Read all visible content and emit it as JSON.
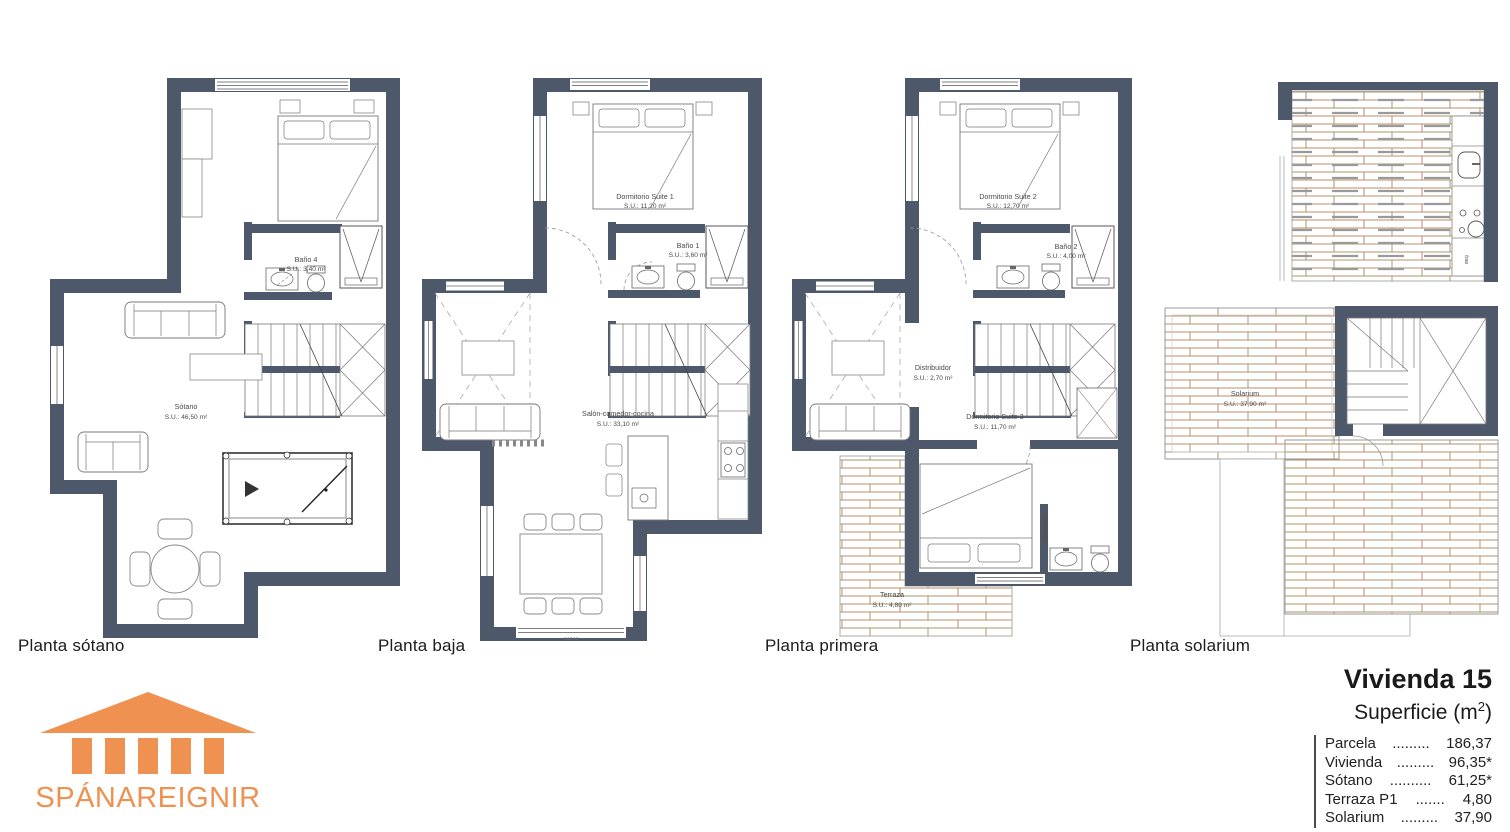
{
  "colors": {
    "wall": "#4e586b",
    "wood": "#b5916e",
    "accent": "#ef9150"
  },
  "plans": [
    {
      "caption": "Planta sótano",
      "rooms": {
        "bano4": {
          "name": "Baño 4",
          "area": "S.U.: 3,40 m²"
        },
        "sotano": {
          "name": "Sótano",
          "area": "S.U.: 46,50 m²"
        }
      }
    },
    {
      "caption": "Planta baja",
      "rooms": {
        "suite1": {
          "name": "Dormitorio Suite 1",
          "area": "S.U.: 11,20 m²"
        },
        "bano1": {
          "name": "Baño 1",
          "area": "S.U.: 3,60 m²"
        },
        "salon": {
          "name": "Salón-comedor-cocina",
          "area": "S.U.: 33,10 m²"
        }
      },
      "window_dim": "2.2X2.2"
    },
    {
      "caption": "Planta primera",
      "rooms": {
        "suite2": {
          "name": "Dormitorio Suite 2",
          "area": "S.U.: 12,70 m²"
        },
        "bano2": {
          "name": "Baño 2",
          "area": "S.U.: 4,00 m²"
        },
        "distribuidor": {
          "name": "Distribuidor",
          "area": "S.U.: 2,70 m²"
        },
        "suite3": {
          "name": "Dormitorio Suite 3",
          "area": "S.U.: 11,70 m²"
        },
        "terraza": {
          "name": "Terraza",
          "area": "S.U.: 4,80 m²"
        }
      }
    },
    {
      "caption": "Planta solarium",
      "rooms": {
        "solarium": {
          "name": "Solarium",
          "area": "S.U.: 37,90 m²"
        }
      },
      "bbq_label": "BBQ"
    }
  ],
  "logo": {
    "text": "SPÁNAREIGNIR"
  },
  "summary": {
    "title": "Vivienda 15",
    "subtitle_prefix": "Superficie (m",
    "subtitle_sup": "2",
    "subtitle_suffix": ")",
    "rows": [
      {
        "label": "Parcela",
        "dots": ".........",
        "value": "186,37"
      },
      {
        "label": "Vivienda",
        "dots": ".........",
        "value": "96,35*"
      },
      {
        "label": "Sótano",
        "dots": "..........",
        "value": "61,25*"
      },
      {
        "label": "Terraza P1",
        "dots": ".......",
        "value": "4,80"
      },
      {
        "label": "Solarium",
        "dots": ".........",
        "value": "37,90"
      }
    ]
  }
}
